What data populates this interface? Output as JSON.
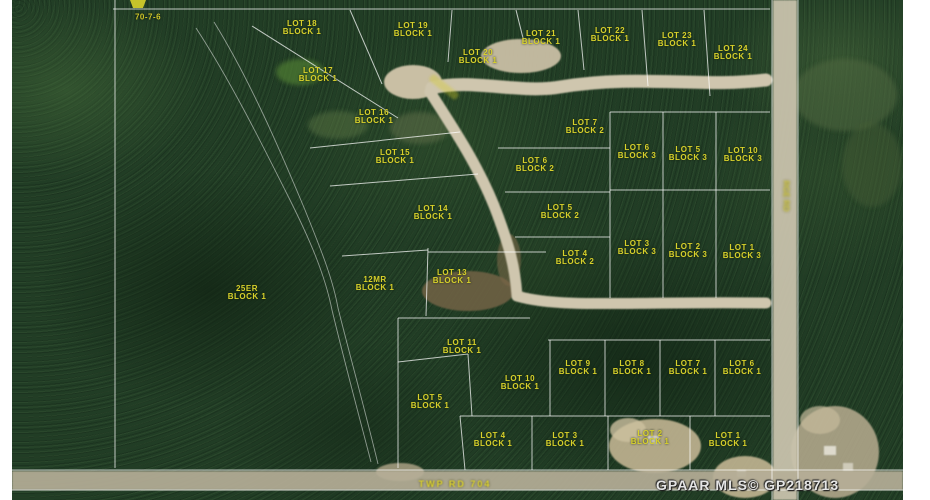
{
  "map": {
    "section_id": "70-7-6",
    "watermark": "GPAAR MLS© GP218713",
    "road_labels": {
      "township_road": "TWP RD 704",
      "range_road": "RGE RD",
      "crescent_road": ""
    },
    "colors": {
      "forest": "#213d25",
      "road": "#cfc6ae",
      "survey_line": "#ffffff",
      "label_text": "#d8d12b"
    },
    "lot_labels": [
      {
        "lines": [
          "LOT 18",
          "BLOCK 1"
        ],
        "x": 302,
        "y": 28
      },
      {
        "lines": [
          "LOT 19",
          "BLOCK 1"
        ],
        "x": 413,
        "y": 30
      },
      {
        "lines": [
          "LOT 21",
          "BLOCK 1"
        ],
        "x": 541,
        "y": 38
      },
      {
        "lines": [
          "LOT 22",
          "BLOCK 1"
        ],
        "x": 610,
        "y": 35
      },
      {
        "lines": [
          "LOT 23",
          "BLOCK 1"
        ],
        "x": 677,
        "y": 40
      },
      {
        "lines": [
          "LOT 24",
          "BLOCK 1"
        ],
        "x": 733,
        "y": 53
      },
      {
        "lines": [
          "LOT 20",
          "BLOCK 1"
        ],
        "x": 478,
        "y": 57
      },
      {
        "lines": [
          "LOT 17",
          "BLOCK 1"
        ],
        "x": 318,
        "y": 75
      },
      {
        "lines": [
          "LOT 16",
          "BLOCK 1"
        ],
        "x": 374,
        "y": 117
      },
      {
        "lines": [
          "LOT 15",
          "BLOCK 1"
        ],
        "x": 395,
        "y": 157
      },
      {
        "lines": [
          "LOT 7",
          "BLOCK 2"
        ],
        "x": 585,
        "y": 127
      },
      {
        "lines": [
          "LOT 6",
          "BLOCK 2"
        ],
        "x": 535,
        "y": 165
      },
      {
        "lines": [
          "LOT 6",
          "BLOCK 3"
        ],
        "x": 637,
        "y": 152
      },
      {
        "lines": [
          "LOT 5",
          "BLOCK 3"
        ],
        "x": 688,
        "y": 154
      },
      {
        "lines": [
          "LOT 10",
          "BLOCK 3"
        ],
        "x": 743,
        "y": 155
      },
      {
        "lines": [
          "LOT 14",
          "BLOCK 1"
        ],
        "x": 433,
        "y": 213
      },
      {
        "lines": [
          "LOT 5",
          "BLOCK 2"
        ],
        "x": 560,
        "y": 212
      },
      {
        "lines": [
          "LOT 4",
          "BLOCK 2"
        ],
        "x": 575,
        "y": 258
      },
      {
        "lines": [
          "LOT 3",
          "BLOCK 3"
        ],
        "x": 637,
        "y": 248
      },
      {
        "lines": [
          "LOT 2",
          "BLOCK 3"
        ],
        "x": 688,
        "y": 251
      },
      {
        "lines": [
          "LOT 1",
          "BLOCK 3"
        ],
        "x": 742,
        "y": 252
      },
      {
        "lines": [
          "12MR",
          "BLOCK 1"
        ],
        "x": 375,
        "y": 284
      },
      {
        "lines": [
          "LOT 13",
          "BLOCK 1"
        ],
        "x": 452,
        "y": 277
      },
      {
        "lines": [
          "25ER",
          "BLOCK 1"
        ],
        "x": 247,
        "y": 293
      },
      {
        "lines": [
          "LOT 11",
          "BLOCK 1"
        ],
        "x": 462,
        "y": 347
      },
      {
        "lines": [
          "LOT 10",
          "BLOCK 1"
        ],
        "x": 520,
        "y": 383
      },
      {
        "lines": [
          "LOT 9",
          "BLOCK 1"
        ],
        "x": 578,
        "y": 368
      },
      {
        "lines": [
          "LOT 8",
          "BLOCK 1"
        ],
        "x": 632,
        "y": 368
      },
      {
        "lines": [
          "LOT 7",
          "BLOCK 1"
        ],
        "x": 688,
        "y": 368
      },
      {
        "lines": [
          "LOT 6",
          "BLOCK 1"
        ],
        "x": 742,
        "y": 368
      },
      {
        "lines": [
          "LOT 5",
          "BLOCK 1"
        ],
        "x": 430,
        "y": 402
      },
      {
        "lines": [
          "LOT 4",
          "BLOCK 1"
        ],
        "x": 493,
        "y": 440
      },
      {
        "lines": [
          "LOT 3",
          "BLOCK 1"
        ],
        "x": 565,
        "y": 440
      },
      {
        "lines": [
          "LOT 2",
          "BLOCK 1"
        ],
        "x": 650,
        "y": 438
      },
      {
        "lines": [
          "LOT 1",
          "BLOCK 1"
        ],
        "x": 728,
        "y": 440
      }
    ]
  }
}
